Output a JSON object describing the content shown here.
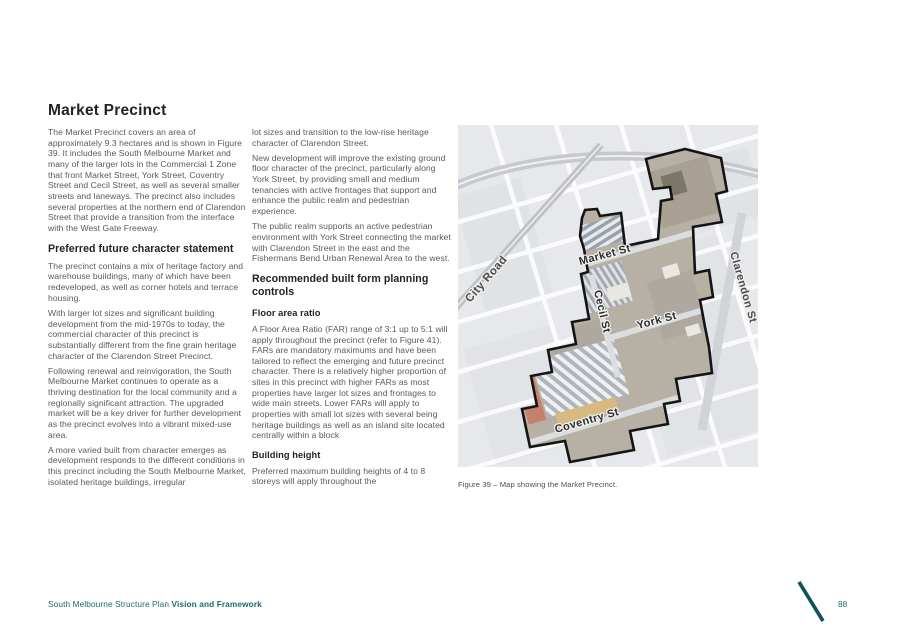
{
  "page_title": "Market Precinct",
  "left_column": {
    "intro": "The Market Precinct covers an area of approximately 9.3 hectares and is shown in Figure 39. It includes the South Melbourne Market and many of the larger lots in the Commercial 1 Zone that front Market Street, York Street, Coventry Street and Cecil Street, as well as several smaller streets and laneways. The precinct also includes several properties at the northern end of Clarendon Street that provide a transition from the interface with the West Gate Freeway.",
    "heading": "Preferred future character statement",
    "para1": "The precinct contains a mix of heritage factory and warehouse buildings, many of which have been redeveloped, as well as corner hotels and terrace housing.",
    "para2": "With larger lot sizes and significant building development from the mid-1970s to today, the commercial character of this precinct is substantially different from the fine grain heritage character of the Clarendon Street Precinct.",
    "para3": "Following renewal and reinvigoration, the South Melbourne Market continues to operate as a thriving destination for the local community and a regionally significant attraction. The upgraded market will be a key driver for further development as the precinct evolves into a vibrant mixed-use area.",
    "para4": "A more varied built from character emerges as development responds to the different conditions in this precinct including the South Melbourne Market, isolated heritage buildings, irregular"
  },
  "middle_column": {
    "para1": "lot sizes and transition to the low-rise heritage character of Clarendon Street.",
    "para2": "New development will improve the existing ground floor character of the precinct, particularly along York Street, by providing small and medium tenancies with active frontages that support and enhance the public realm and pedestrian experience.",
    "para3": "The public realm supports an active pedestrian environment with York Street connecting the market with Clarendon Street in the east and the Fishermans Bend Urban Renewal Area to the west.",
    "heading": "Recommended built form planning controls",
    "sub1_title": "Floor area ratio",
    "sub1_text": "A Floor Area Ratio (FAR) range of 3:1 up to 5:1 will apply throughout the precinct (refer to Figure 41). FARs are mandatory maximums and have been tailored to reflect the emerging and future precinct character. There is a relatively higher proportion of sites in this precinct with higher FARs as most properties have larger lot sizes and frontages to wide main streets. Lower FARs will apply to properties with small lot sizes with several being heritage buildings as well as an island site located centrally within a block",
    "sub2_title": "Building height",
    "sub2_text": "Preferred maximum building heights of 4 to 8 storeys will apply throughout the"
  },
  "figure": {
    "caption": "Figure 39 – Map showing the Market Precinct.",
    "streets": {
      "market": "Market St",
      "cecil": "Cecil St",
      "york": "York St",
      "coventry": "Coventry St",
      "clarendon": "Clarendon St",
      "city_road": "City Road"
    }
  },
  "footer": {
    "doc_title": "South Melbourne Structure Plan ",
    "doc_emphasis": "Vision and Framework",
    "page_number": "88"
  },
  "colors": {
    "accent_teal": "#1a6b74",
    "heading_dark": "#232228",
    "body_gray": "#5a5a5e"
  }
}
